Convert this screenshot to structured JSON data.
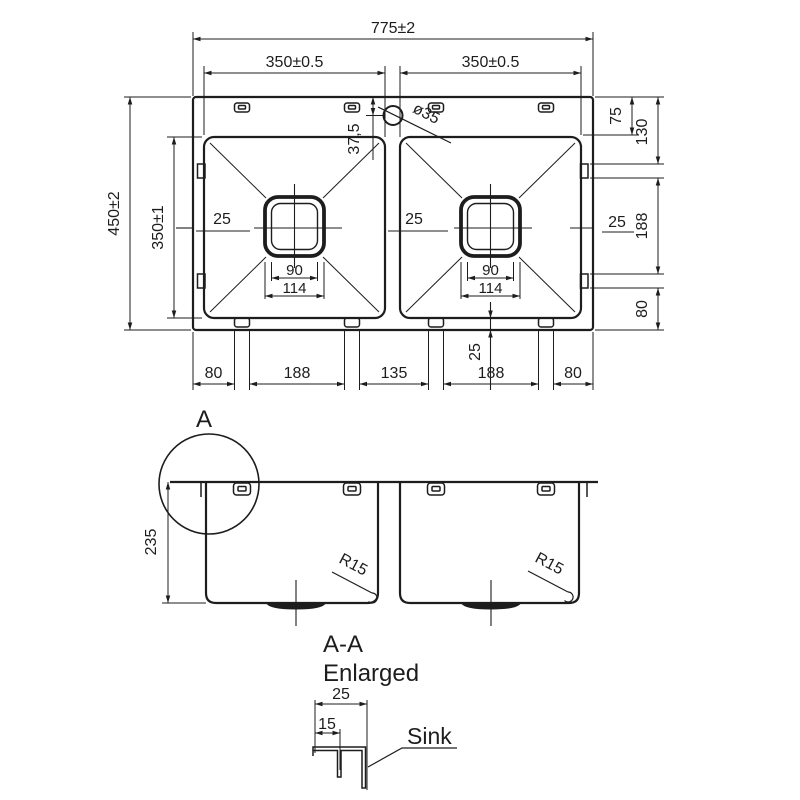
{
  "colors": {
    "line": "#1d1d1d",
    "background": "#ffffff"
  },
  "top_view": {
    "overall_width": "775±2",
    "left_bowl_width": "350±0.5",
    "right_bowl_width": "350±0.5",
    "overall_depth": "450±2",
    "bowl_depth": "350±1",
    "faucet_hole_diameter": "ø35",
    "faucet_hole_offset": "37,5",
    "left_bowl_radius": "25",
    "right_bowl_radius": "25",
    "right_edge_radius": "25",
    "left_drain_inner": "90",
    "left_drain_outer": "114",
    "right_drain_inner": "90",
    "right_drain_outer": "114",
    "rim_to_bowl": "75",
    "rim_to_clip": "130",
    "clip_spacing_right": "188",
    "clip_to_bottom": "80",
    "bottom_dims": [
      "80",
      "188",
      "135",
      "188",
      "80"
    ],
    "bowl_to_edge_bottom": "25"
  },
  "section_view": {
    "detail_marker": "A",
    "bowl_depth": "235",
    "left_corner_radius": "R15",
    "right_corner_radius": "R15"
  },
  "detail_view": {
    "title": "A-A",
    "subtitle": "Enlarged",
    "rim_width": "25",
    "clip_channel_offset": "15",
    "callout": "Sink"
  }
}
